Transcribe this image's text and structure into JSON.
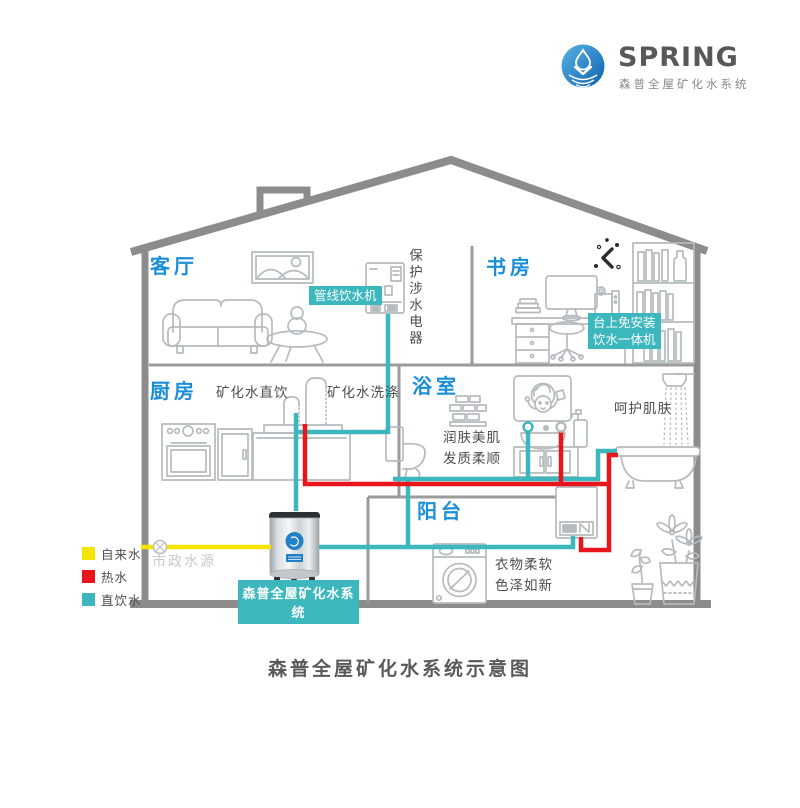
{
  "logo": {
    "brand": "SPRING",
    "subtitle": "森普全屋矿化水系统",
    "icon": "water-drop-ripple-icon"
  },
  "rooms": {
    "living": "客厅",
    "study": "书房",
    "kitchen": "厨房",
    "bath": "浴室",
    "balcony": "阳台"
  },
  "labels": {
    "pipeline_dispenser": "管线饮水机",
    "protect_appliance": "保护涉水电器",
    "countertop_line1": "台上免安装",
    "countertop_line2": "饮水一体机",
    "mineral_drinking": "矿化水直饮",
    "mineral_washing": "矿化水洗涤",
    "skin_line1": "润肤美肌",
    "skin_line2": "发质柔顺",
    "shower_care": "呵护肌肤",
    "laundry_line1": "衣物柔软",
    "laundry_line2": "色泽如新",
    "municipal_source": "市政水源",
    "tank_banner": "森普全屋矿化水系统"
  },
  "legend": {
    "items": [
      {
        "label": "自来水",
        "color": "#f6e400"
      },
      {
        "label": "热水",
        "color": "#e8151d"
      },
      {
        "label": "直饮水",
        "color": "#3cb7be"
      }
    ]
  },
  "caption": "森普全屋矿化水系统示意图",
  "colors": {
    "room_label": "#1a8fd8",
    "chip_bg": "#3cb7be",
    "pipe_tap": "#f6e400",
    "pipe_hot": "#e8151d",
    "pipe_drinking": "#3cb7be",
    "wall": "#8c8c8c"
  }
}
